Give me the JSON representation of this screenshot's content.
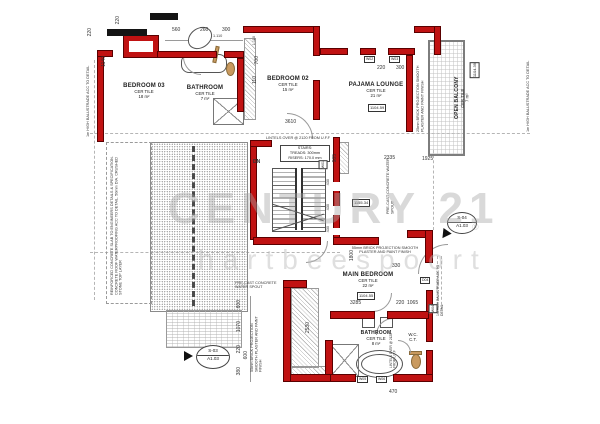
{
  "watermark": {
    "brand": "CENTURY 21",
    "sub": "hartbeespoort",
    "reg": "®"
  },
  "rooms": {
    "bedroom03": {
      "name": "BEDROOM 03",
      "finish": "CER TILE",
      "area": "18 m²"
    },
    "bathroom_top": {
      "name": "BATHROOM",
      "finish": "CER TILE",
      "area": "7 m²"
    },
    "bedroom02": {
      "name": "BEDROOM 02",
      "finish": "CER TILE",
      "area": "15 m²"
    },
    "pajama": {
      "name": "PAJAMA LOUNGE",
      "finish": "CER TILE",
      "area": "21 m²",
      "level": "1104.59"
    },
    "balcony": {
      "name": "OPEN BALCONY",
      "finish": "CER TILE",
      "area": "7 m²",
      "level": "1104.39"
    },
    "main_bedroom": {
      "name": "MAIN BEDROOM",
      "finish": "CER TILE",
      "area": "22 m²",
      "level": "1104.55"
    },
    "bathroom_bottom": {
      "name": "BATHROOM",
      "finish": "CER TILE",
      "area": "8 m²"
    },
    "wc": {
      "name": "W.C.",
      "finish": "C.T."
    }
  },
  "stairs": {
    "dn": "DN",
    "title": "STAIRS:",
    "treads": "TREADS: 300mm",
    "risers": "RISERS: 170.0 mm",
    "lintel": "LINTELS OVER @ 2120 FROM U.F.F",
    "level": "1155.34"
  },
  "notes": {
    "balustrade": "1m HIGH BALUSTRADE ACC TO DETAIL",
    "roof": "REINFORCED CONCRETE SLAB TO ENGINEERS DETAILS & SPECIFICATION. CONCRETE ROOF WATERPROOFING ACC TO DETAIL. 50mm DIA. CRUSHED STONE TOP LAYER",
    "spout": "PRE-CAST CONCRETE WATER SPOUT",
    "brick55": "55mm BRICK PROJECTION SMOOTH PLASTER AND PAINT FINISH",
    "brick25": "25mm BRICK PROJECTION SMOOTH PLASTER AND PAINT FINISH",
    "lintels": "LINTELS OVER @ 2120 FROM U.F.F"
  },
  "windows": {
    "w01": "W01",
    "w02": "W02",
    "w03": "W03",
    "w04": "W04",
    "w05": "W05",
    "w06": "W06",
    "d04": "D04"
  },
  "section": {
    "s1_top": "S-03",
    "s1_bot": "A1.03",
    "s2_top": "S-04",
    "s2_bot": "A1.03"
  },
  "dims": {
    "d110": "110",
    "d220": "220",
    "d260": "260",
    "d300": "300",
    "d330": "330",
    "d380": "380",
    "d430": "430",
    "d470": "470",
    "d560": "560",
    "d600": "600",
    "d700": "700",
    "d985": "985",
    "d1065": "1065",
    "d1070": "1070",
    "d1110": "1.110",
    "d1140": "1140",
    "d1800": "1800",
    "d1925": "1925",
    "d2335": "2335",
    "d2530": "2530",
    "d3285": "3285",
    "d3610": "3610"
  },
  "colors": {
    "wall_red": "#c01212",
    "hatch_gray": "#9a9a9a",
    "watermark_gray": "#bdbdbd",
    "fixture_tan": "#c99a5f"
  }
}
